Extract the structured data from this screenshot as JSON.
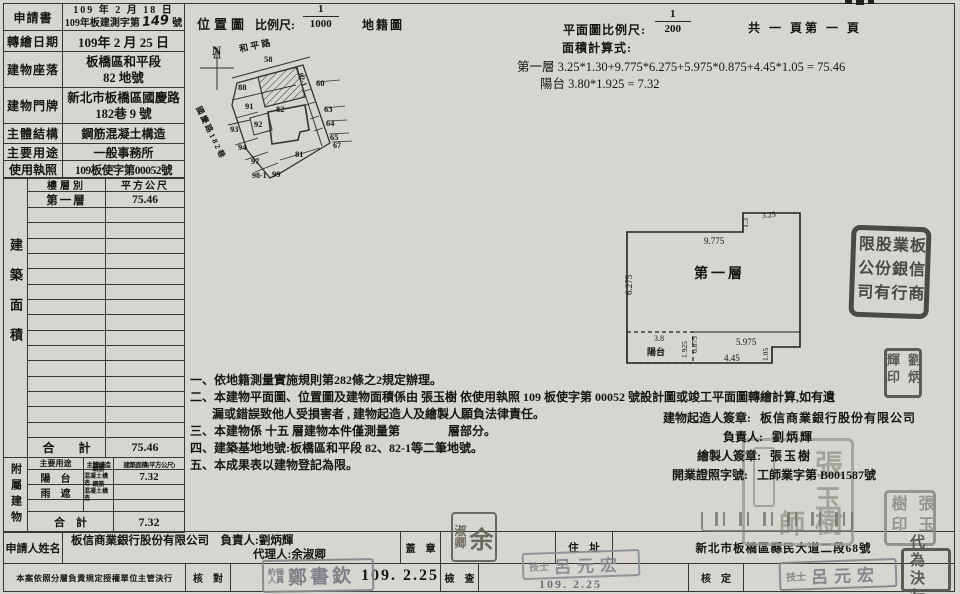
{
  "form": {
    "rows": [
      {
        "label": "申請書",
        "line1": "109 年 2 月 18 日",
        "line2_pre": "109年板建測字第",
        "line2_hand": "149",
        "line2_post": "號"
      },
      {
        "label": "轉繪日期",
        "line1": "109年 2 月 25 日"
      },
      {
        "label": "建物座落",
        "line1": "板橋區和平段",
        "line2": "82  地號"
      },
      {
        "label": "建物門牌",
        "line1": "新北市板橋區國慶路",
        "line2": "182巷 9 號"
      },
      {
        "label": "主體結構",
        "line1": "鋼筋混凝土構造"
      },
      {
        "label": "主要用途",
        "line1": "一般事務所"
      },
      {
        "label": "使用執照",
        "line1": "109板使字第00052號"
      }
    ]
  },
  "area_table": {
    "side_label": "建築面積",
    "col_floor": "樓層別",
    "col_area": "平方公尺",
    "row1_floor": "第一層",
    "row1_area": "75.46",
    "total_label": "合　　計",
    "total_area": "75.46"
  },
  "annex_table": {
    "side_label": "附屬建物",
    "col_use": "主要用途",
    "col_struct": "主體構造",
    "col_area": "建築面積(平方公尺)",
    "row1_use": "陽　台",
    "row1_struct_a": "鋼筋",
    "row1_struct_b": "混凝土構造",
    "row1_area": "7.32",
    "row2_use": "雨　遮",
    "row2_struct_a": "鋼筋",
    "row2_struct_b": "混凝土構造",
    "row2_area": "",
    "total_label": "合　計",
    "total_area": "7.32"
  },
  "location_map": {
    "title": "位置圖",
    "scale_label": "比例尺:",
    "scale_num": "1",
    "scale_den": "1000",
    "map_type": "地籍圖",
    "north": "N",
    "road_top": "和 平 路",
    "road_left": "國慶路182巷",
    "lots": {
      "l58": "58",
      "l82_1": "82-1",
      "l60": "60",
      "l88": "88",
      "l91": "91",
      "l82": "82",
      "l63": "63",
      "l92": "92",
      "l64": "64",
      "l93": "93",
      "l65": "65",
      "l94": "94",
      "l67": "67",
      "l97": "97",
      "l81": "81",
      "l98_1": "98-1",
      "l99": "99"
    }
  },
  "plan": {
    "scale_label": "平面圖比例尺:",
    "scale_num": "1",
    "scale_den": "200",
    "pages": "共 一 頁第 一 頁",
    "calc_title": "面積計算式:",
    "calc_line1": "第一層 3.25*1.30+9.775*6.275+5.975*0.875+4.45*1.05 = 75.46",
    "calc_line2": "陽台 3.80*1.925 = 7.32",
    "floor_label": "第一層",
    "balcony_label": "陽台",
    "dims": {
      "notch_w": "3.25",
      "notch_h": "1.3",
      "top_w": "9.775",
      "left_h": "6.275",
      "balcony_w": "3.8",
      "balcony_h": "1.925",
      "step_h": "0.875",
      "mid_w": "5.975",
      "bottom_w": "4.45",
      "right_step": "1.05"
    }
  },
  "notes": {
    "n1": "一、依地籍測量實施規則第282條之2規定辦理。",
    "n2a": "二、本建物平面圖、位置圖及建物面積係由 張玉樹 依使用執照 109 板使字第 00052 號設計圖或竣工平面圖轉繪計算,如有遺",
    "n2b": "漏或錯誤致他人受損害者 , 建物起造人及繪製人願負法律責任。",
    "n3": "三、本建物係 十五 層建物本件僅測量第　　　　層部分。",
    "n4": "四、建築基地地號:板橋區和平段 82、82-1等二筆地號。",
    "n5": "五、本成果表以建物登記為限。"
  },
  "signers": {
    "builder_label": "建物起造人簽章:",
    "builder": "板信商業銀行股份有限公司",
    "owner_label": "負責人:",
    "owner": "劉炳輝",
    "drafter_label": "繪製人簽章:",
    "drafter": "張玉樹",
    "license_label": "開業證照字號:",
    "license": "工師業字第 B001587號"
  },
  "applicant": {
    "label": "申請人姓名",
    "company": "板信商業銀行股份有限公司",
    "rep": "負責人:劉炳輝",
    "agent": "代理人:余淑卿",
    "seal_label": "蓋　章",
    "addr_label": "住　址",
    "address": "新北市板橋區縣民大道二段68號"
  },
  "approval": {
    "policy": "本案依照分層負責規定授權單位主管決行",
    "check_label": "核　對",
    "check_date": "109. 2.25",
    "inspect_label": "檢　查",
    "inspect_date": "109. 2.25",
    "approve_label": "核　定"
  },
  "stamps": {
    "company_seal": "板信商業銀行股份有限公司",
    "owner_seal_col1": "劉炳",
    "owner_seal_col2": "輝印",
    "architect_c1": "張",
    "architect_c2": "玉",
    "architect_c3": "樹",
    "architect_c4": "師",
    "drafter_seal_col1": "張玉",
    "drafter_seal_col2": "樹印",
    "agent_seal_big": "余",
    "agent_seal_s1": "淑",
    "agent_seal_s2": "卿",
    "clerk_prefix_a": "約僱",
    "clerk_prefix_b": "人員",
    "clerk_name": "鄭書欽",
    "tech_prefix": "技士",
    "tech_name": "呂元宏",
    "deputy_row1": "代為",
    "deputy_row2": "決行"
  }
}
